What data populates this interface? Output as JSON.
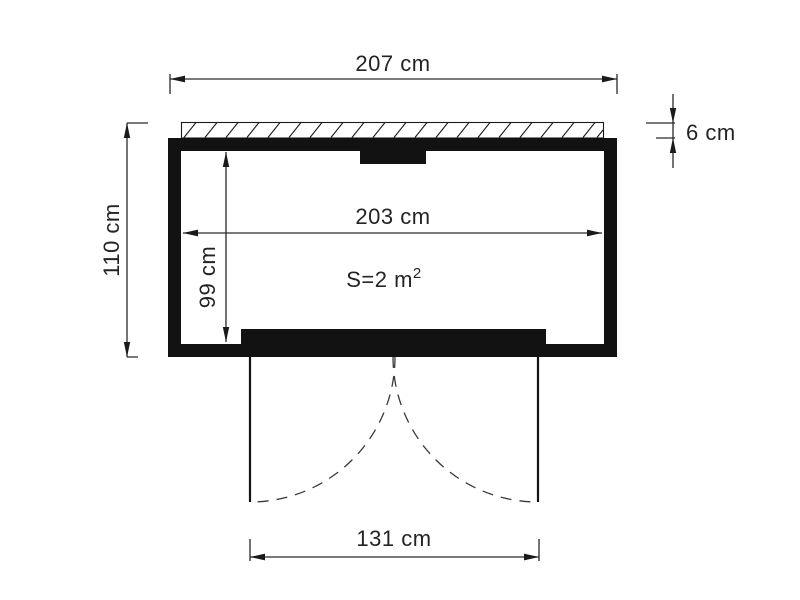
{
  "drawing": {
    "dimensions": {
      "overall_width": "207 cm",
      "overall_depth": "110 cm",
      "roof_edge_thickness": "6 cm",
      "inner_width": "203 cm",
      "inner_depth": "99 cm",
      "door_opening": "131 cm"
    },
    "area": {
      "main": "S=2 m",
      "exponent": "2"
    },
    "colors": {
      "line": "#1a1a1a",
      "wall_fill": "#121212",
      "background": "#ffffff"
    }
  }
}
